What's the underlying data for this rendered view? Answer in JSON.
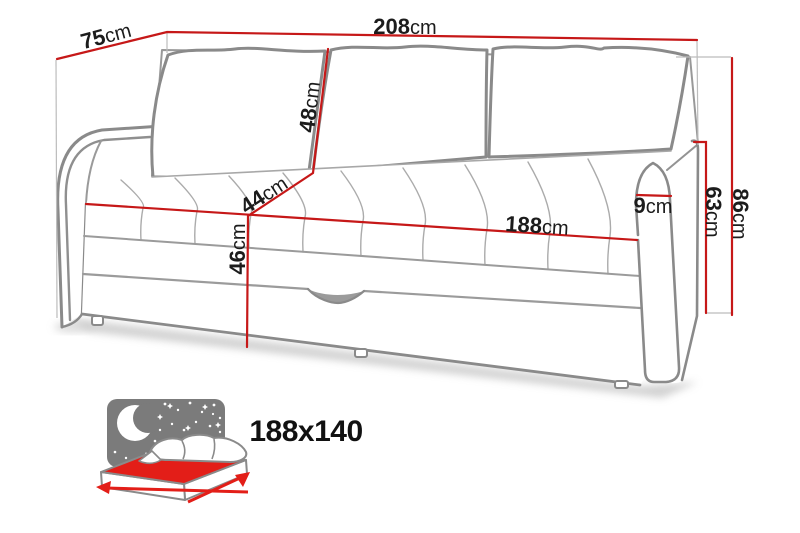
{
  "product_diagram": {
    "type": "sofa-bed dimension drawing",
    "dimensions": {
      "total_width": {
        "value": "208",
        "unit": "cm"
      },
      "depth": {
        "value": "75",
        "unit": "cm"
      },
      "back_cushion_height": {
        "value": "48",
        "unit": "cm"
      },
      "seat_depth": {
        "value": "44",
        "unit": "cm"
      },
      "seat_height": {
        "value": "46",
        "unit": "cm"
      },
      "seat_width": {
        "value": "188",
        "unit": "cm"
      },
      "armrest_width": {
        "value": "9",
        "unit": "cm"
      },
      "armrest_height": {
        "value": "63",
        "unit": "cm"
      },
      "total_height": {
        "value": "86",
        "unit": "cm"
      }
    },
    "sleeping_area": {
      "size": "188x140"
    },
    "colors": {
      "dimension_line_red": "#c61818",
      "icon_red": "#e31e18",
      "outline_gray": "#8a8a8a",
      "night_panel_gray": "#7b7b7b",
      "extension_line_gray": "#bcbcbc",
      "text": "#1c1c1c"
    },
    "icons": [
      {
        "name": "night-sleep-icon",
        "meaning": "fold-out sleeping function with moon, stars and bed"
      }
    ]
  }
}
